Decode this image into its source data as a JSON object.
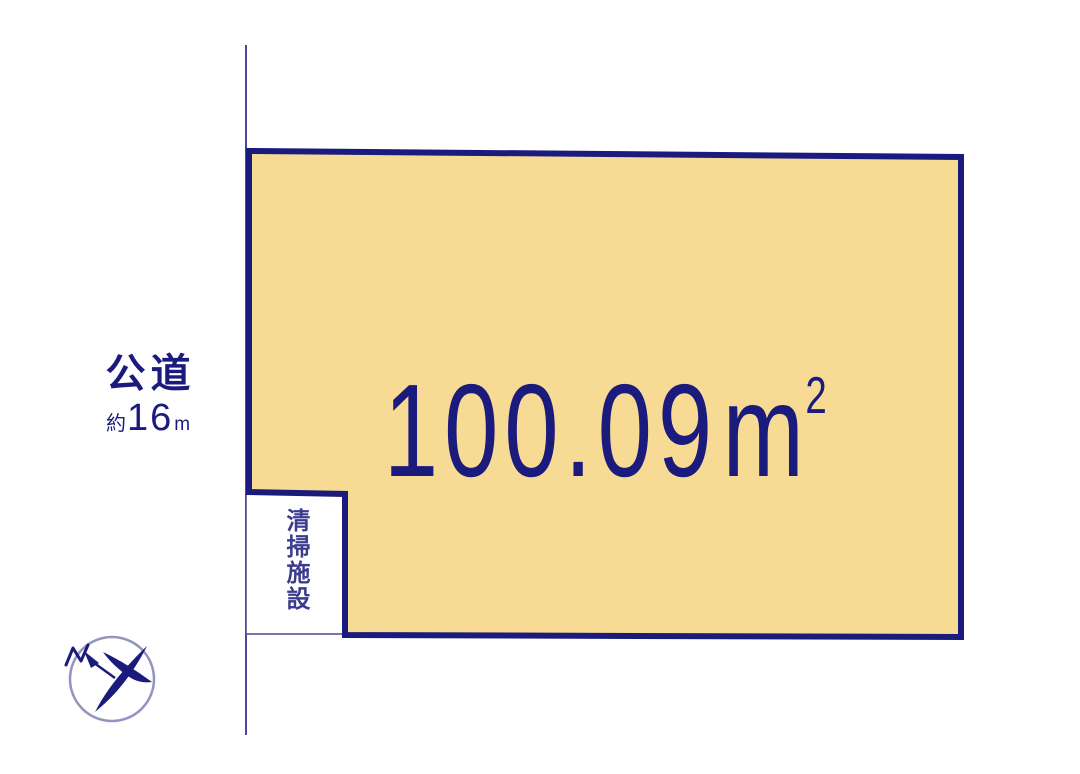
{
  "plot": {
    "area_value": "100.09",
    "area_unit_base": "m",
    "area_unit_exponent": "2",
    "fill_color": "#f7db95",
    "border_color": "#1b1b7d"
  },
  "road": {
    "type_label": "公道",
    "approx_prefix": "約",
    "width_value": "16",
    "width_unit": "m",
    "line_color": "#4a4a94"
  },
  "facility": {
    "label": "清掃施設",
    "text_color": "#3c3c8e"
  },
  "compass": {
    "north_mark": "N",
    "ring_color": "#9393c0",
    "needle_color": "#1b1b7d"
  },
  "colors": {
    "background": "#ffffff",
    "navy_text": "#1b1b7d"
  }
}
